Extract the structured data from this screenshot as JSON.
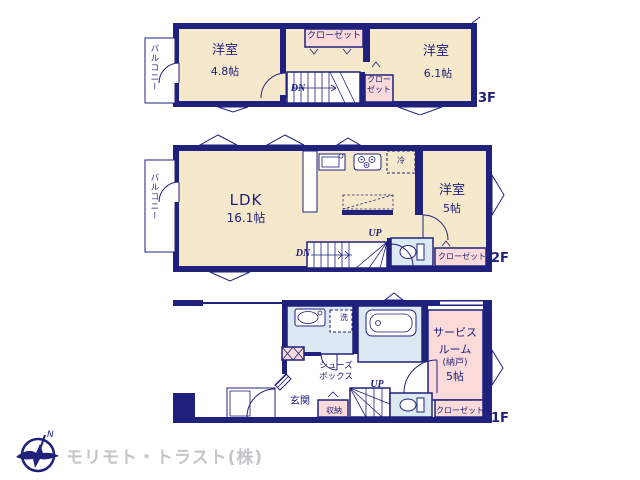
{
  "colors": {
    "wall": "#20217c",
    "floor": "#f6e8ca",
    "pink": "#fadbda",
    "blue": "#dce9f3",
    "logo": "#c6c6ca"
  },
  "floor3": {
    "label": "3F",
    "room_left_name": "洋室",
    "room_left_size": "4.8帖",
    "room_right_name": "洋室",
    "room_right_size": "6.1帖",
    "closet_top": "クローゼット",
    "closet_small_line1": "クロー",
    "closet_small_line2": "ゼット",
    "stairs_down": "DN",
    "balcony": "バルコニー"
  },
  "floor2": {
    "label": "2F",
    "ldk_name": "LDK",
    "ldk_size": "16.1帖",
    "room_name": "洋室",
    "room_size": "5帖",
    "closet": "クローゼット",
    "fridge": "冷",
    "stairs_up": "UP",
    "stairs_down": "DN",
    "balcony": "バルコニー"
  },
  "floor1": {
    "label": "1F",
    "service_room_line1": "サービス",
    "service_room_line2": "ルーム",
    "service_room_line3": "(納戸)",
    "service_room_line4": "5帖",
    "shoe_box_line1": "シューズ",
    "shoe_box_line2": "ボックス",
    "entrance": "玄関",
    "storage": "収納",
    "closet": "クローゼット",
    "laundry": "洗",
    "stairs_up": "UP"
  },
  "footer": {
    "company": "モリモト・トラスト(株)",
    "compass_n": "N"
  }
}
